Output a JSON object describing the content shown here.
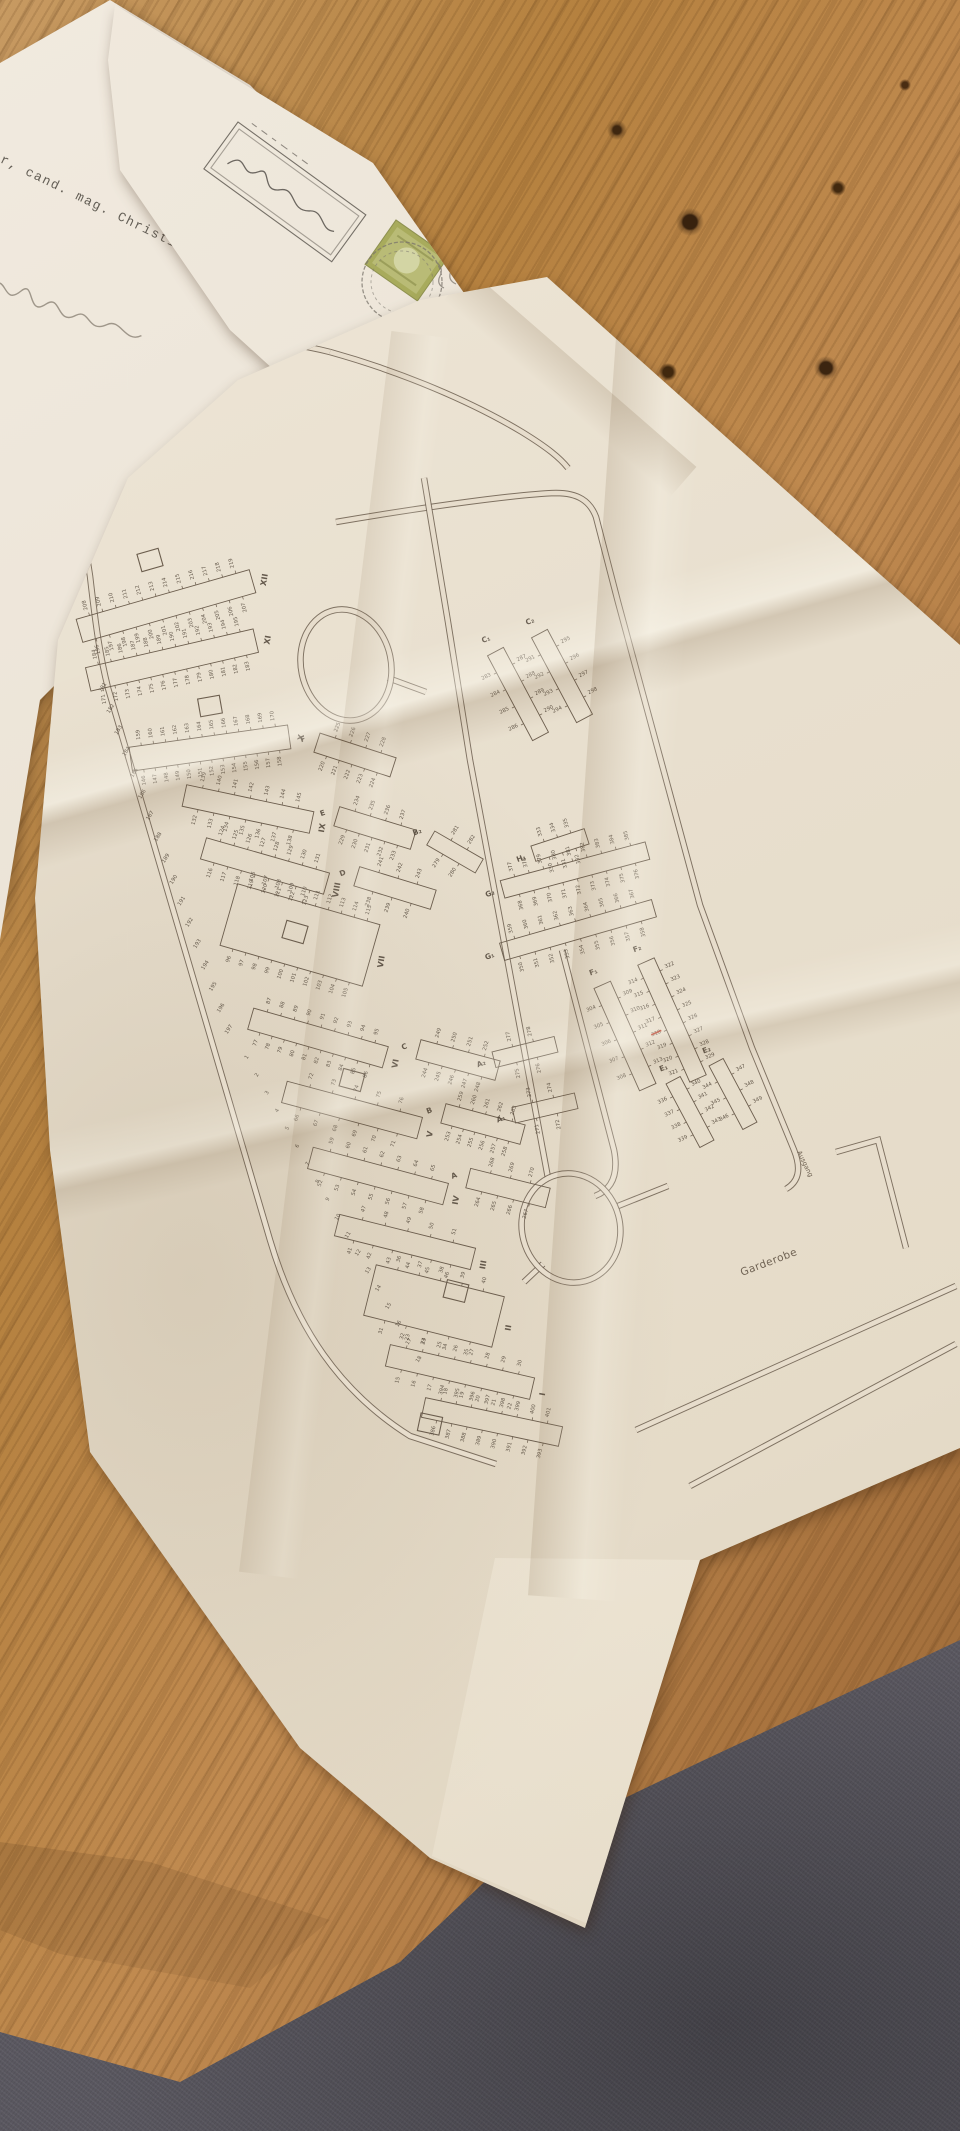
{
  "letter": {
    "typed_text": "er, cand. mag. Christian"
  },
  "envelope": {
    "stamp_color": "#a8ab5c"
  },
  "map": {
    "labels": {
      "garderobe": "Garderobe",
      "ausgang": "Ausgang"
    },
    "red_marked_plot": "318",
    "perimeter": {
      "seq1_from": 181,
      "seq1_to": 197,
      "seq2_from": 1,
      "seq2_to": 18
    },
    "sections": [
      {
        "key": "XII",
        "label": "XII",
        "from": 196,
        "to": 219
      },
      {
        "key": "XI",
        "label": "XI",
        "from": 171,
        "to": 195
      },
      {
        "key": "X",
        "label": "X",
        "from": 146,
        "to": 170
      },
      {
        "key": "IX",
        "label": "IX",
        "from": 132,
        "to": 145
      },
      {
        "key": "VIII",
        "label": "VIII",
        "from": 116,
        "to": 131
      },
      {
        "key": "VII",
        "label": "VII",
        "from": 96,
        "to": 115
      },
      {
        "key": "VI",
        "label": "VI",
        "from": 77,
        "to": 95
      },
      {
        "key": "V",
        "label": "V",
        "from": 66,
        "to": 76
      },
      {
        "key": "IV",
        "label": "IV",
        "from": 52,
        "to": 65
      },
      {
        "key": "III",
        "label": "III",
        "from": 41,
        "to": 51
      },
      {
        "key": "II",
        "label": "II",
        "from": 31,
        "to": 40
      },
      {
        "key": "I",
        "label": "I",
        "from": 15,
        "to": 30
      },
      {
        "key": "F",
        "label": "F",
        "from": 220,
        "to": 228
      },
      {
        "key": "E",
        "label": "E",
        "from": 229,
        "to": 237
      },
      {
        "key": "D",
        "label": "D",
        "from": 238,
        "to": 243
      },
      {
        "key": "C",
        "label": "C",
        "from": 244,
        "to": 252
      },
      {
        "key": "B",
        "label": "B",
        "from": 253,
        "to": 263
      },
      {
        "key": "A",
        "label": "A",
        "from": 264,
        "to": 270
      },
      {
        "key": "A1",
        "label": "A₁",
        "from": 271,
        "to": 274
      },
      {
        "key": "A2",
        "label": "A₂",
        "from": 275,
        "to": 278
      },
      {
        "key": "B2",
        "label": "B₂",
        "from": 279,
        "to": 282
      },
      {
        "key": "C1",
        "label": "C₁",
        "from": 283,
        "to": 290
      },
      {
        "key": "C2",
        "label": "C₂",
        "from": 291,
        "to": 298
      },
      {
        "key": "F1",
        "label": "F₁",
        "from": 304,
        "to": 313
      },
      {
        "key": "F2",
        "label": "F₂",
        "from": 314,
        "to": 329
      },
      {
        "key": "H1",
        "label": "H₁",
        "from": 330,
        "to": 335
      },
      {
        "key": "E1",
        "label": "E₁",
        "from": 336,
        "to": 343
      },
      {
        "key": "E2",
        "label": "E₂",
        "from": 344,
        "to": 349
      },
      {
        "key": "G1",
        "label": "G₁",
        "from": 350,
        "to": 367
      },
      {
        "key": "G2",
        "label": "G₂",
        "from": 368,
        "to": 385
      },
      {
        "key": "ROWX",
        "label": "",
        "from": 386,
        "to": 401
      }
    ]
  }
}
